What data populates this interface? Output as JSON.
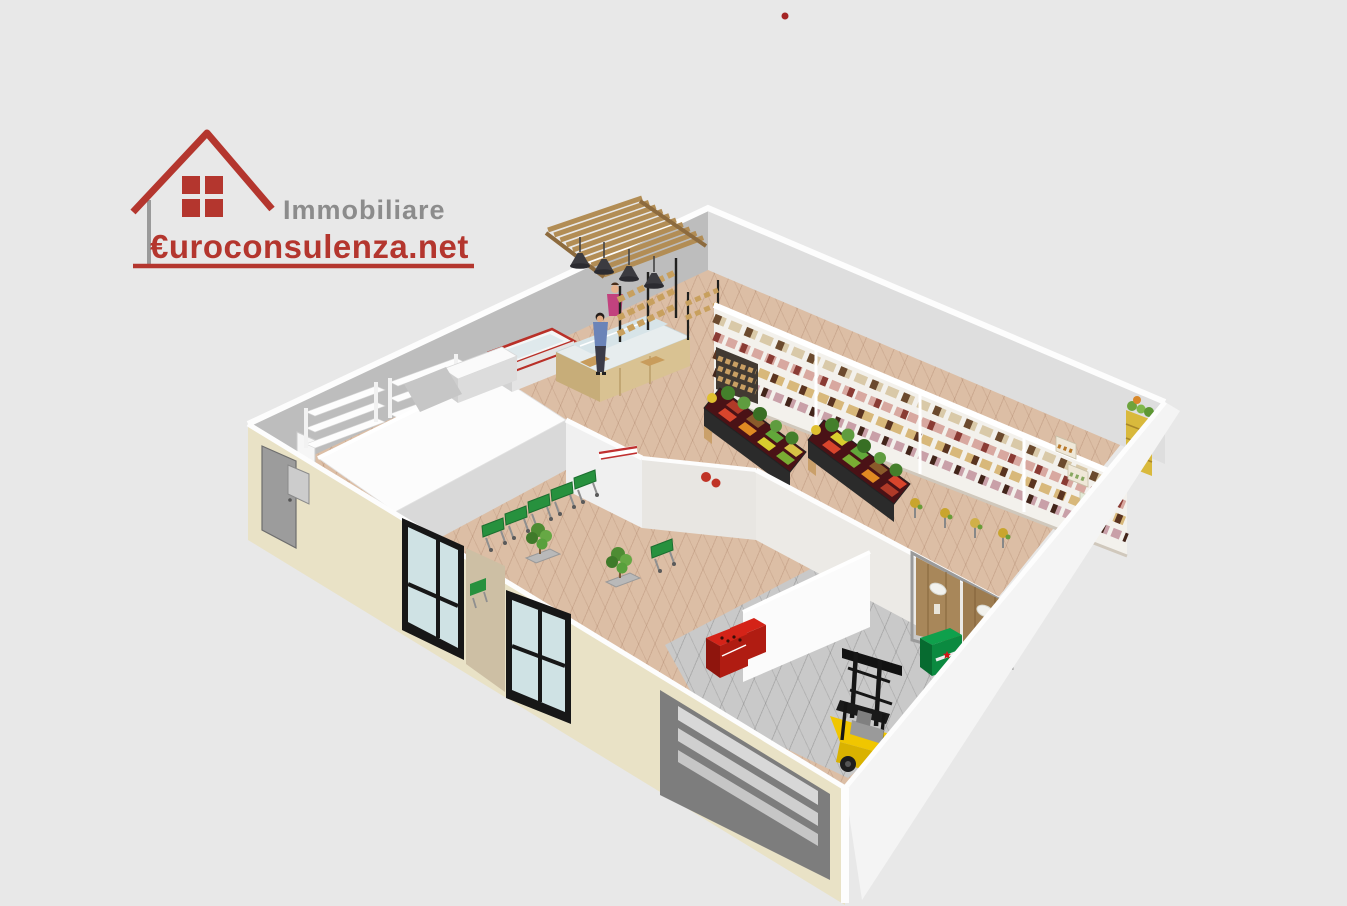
{
  "canvas": {
    "width": 1347,
    "height": 906,
    "background": "#e8e8e8"
  },
  "watermark": {
    "line1": "Immobiliare",
    "line2": "€uroconsulenza.net",
    "line1_color": "#8c8c8c",
    "line2_color": "#b4362e",
    "house_color": "#b4362e"
  },
  "marker": {
    "color": "#a42424"
  },
  "scene": {
    "kind": "3d-floorplan-render",
    "subject": "Supermarket retail space, perspective 3D plan",
    "areas": [
      "sales floor",
      "entrance lobby",
      "storeroom",
      "roofed back rooms",
      "warehouse"
    ],
    "palette": {
      "exterior_wall": "#e9e2c6",
      "interior_wall": "#f0f0f0",
      "back_wall_gray": "#bdbdbd",
      "sales_floor": "#dcbea5",
      "warehouse_floor": "#c9c9c9",
      "wood": "#b28d55",
      "cart_green": "#27913e",
      "forklift_yellow": "#f0c600",
      "soda_crate_red": "#c42015",
      "beer_crate_green": "#0b8a40",
      "door_frame_black": "#171717",
      "glass": "#cfe2e4"
    },
    "objects": [
      {
        "name": "pergola-canopy"
      },
      {
        "name": "pendant-lamp",
        "count": 4
      },
      {
        "name": "deli-counter"
      },
      {
        "name": "deli-staff-figure"
      },
      {
        "name": "customer-figure"
      },
      {
        "name": "bread-rack",
        "count": 2
      },
      {
        "name": "wall-shelving-gondola",
        "sections": 4
      },
      {
        "name": "produce-island",
        "count": 2
      },
      {
        "name": "checkout-counter",
        "count": 2
      },
      {
        "name": "shopping-cart",
        "count": 6
      },
      {
        "name": "entrance-door",
        "count": 2
      },
      {
        "name": "potted-plant",
        "count": 2
      },
      {
        "name": "storeroom-shelving"
      },
      {
        "name": "warehouse-double-doors"
      },
      {
        "name": "forklift"
      },
      {
        "name": "beer-crate",
        "label": "Heineken"
      },
      {
        "name": "soda-crate",
        "count": 2
      },
      {
        "name": "garage-opening"
      },
      {
        "name": "side-door"
      },
      {
        "name": "fruit-crate-stack"
      }
    ]
  }
}
